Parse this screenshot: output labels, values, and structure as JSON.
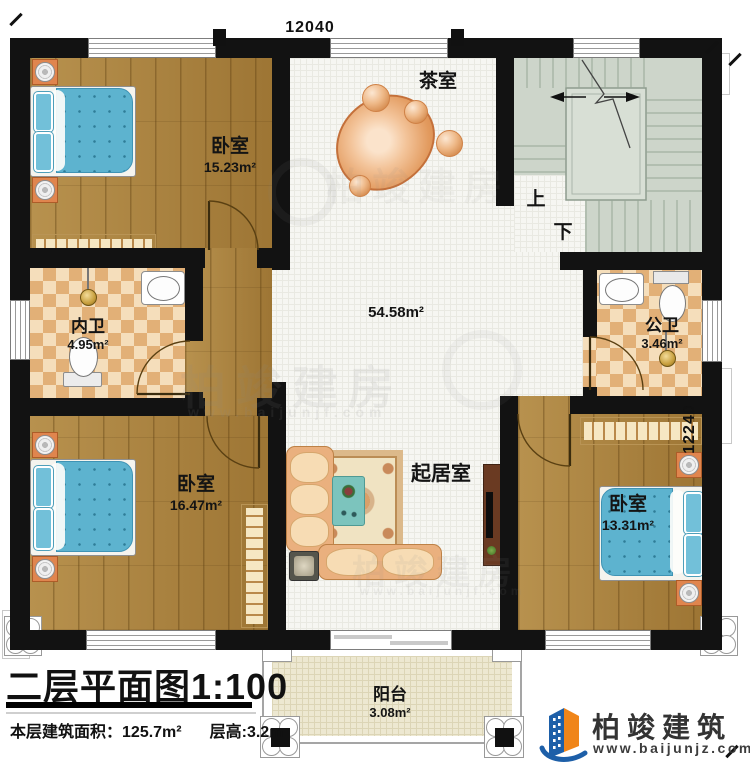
{
  "plan": {
    "title": "二层平面图",
    "scale": "1:100",
    "area_label": "本层建筑面积：",
    "area_value": "125.7m²",
    "floor_height": "层高:3.2m"
  },
  "dimensions": {
    "top": "12040",
    "right": "12240"
  },
  "rooms": {
    "bedroom_tl": {
      "name": "卧室",
      "area": "15.23m²"
    },
    "tea_room": {
      "name": "茶室"
    },
    "hall": {
      "area": "54.58m²"
    },
    "bath_inner": {
      "name": "内卫",
      "area": "4.95m²"
    },
    "bath_public": {
      "name": "公卫",
      "area": "3.46m²"
    },
    "bedroom_bl": {
      "name": "卧室",
      "area": "16.47m²"
    },
    "living_room": {
      "name": "起居室"
    },
    "bedroom_br": {
      "name": "卧室",
      "area": "13.31m²"
    },
    "balcony": {
      "name": "阳台",
      "area": "3.08m²"
    },
    "stairs": {
      "up": "上",
      "down": "下"
    }
  },
  "branding": {
    "name": "柏竣建筑",
    "url": "www.baijunjz.com"
  },
  "watermark": {
    "text": "柏竣建房",
    "url": "www.baijunjf.com"
  },
  "colors": {
    "wall": "#121212",
    "wood": "#a8803c",
    "tile": "#e2b077",
    "stair": "#cdd5ca",
    "logo_blue": "#1d5fa8",
    "logo_orange": "#f08519"
  }
}
